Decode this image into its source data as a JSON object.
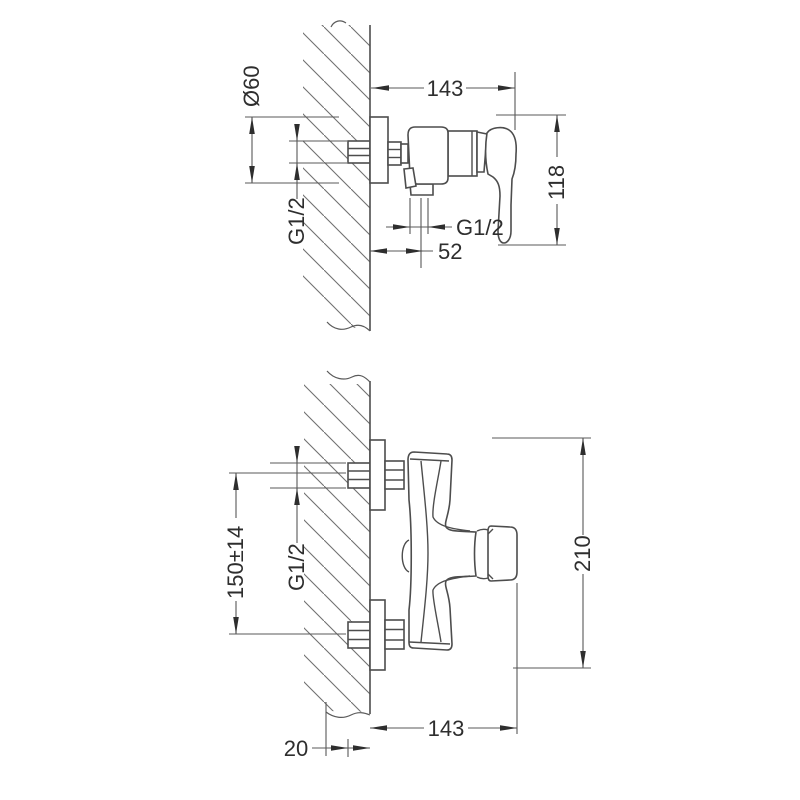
{
  "colors": {
    "background": "#ffffff",
    "object_line": "#4d4d4d",
    "dimension_line": "#585858",
    "text": "#2e2e2e"
  },
  "views": {
    "top": {
      "dims": {
        "flange_diameter": "Ø60",
        "inlet_thread": "G1/2",
        "depth": "143",
        "height": "118",
        "outlet_thread": "G1/2",
        "outlet_offset": "52"
      }
    },
    "bottom": {
      "dims": {
        "inlet_spacing": "150±14",
        "inlet_thread": "G1/2",
        "overall_height": "210",
        "depth": "143",
        "wall_thickness": "20"
      }
    }
  }
}
